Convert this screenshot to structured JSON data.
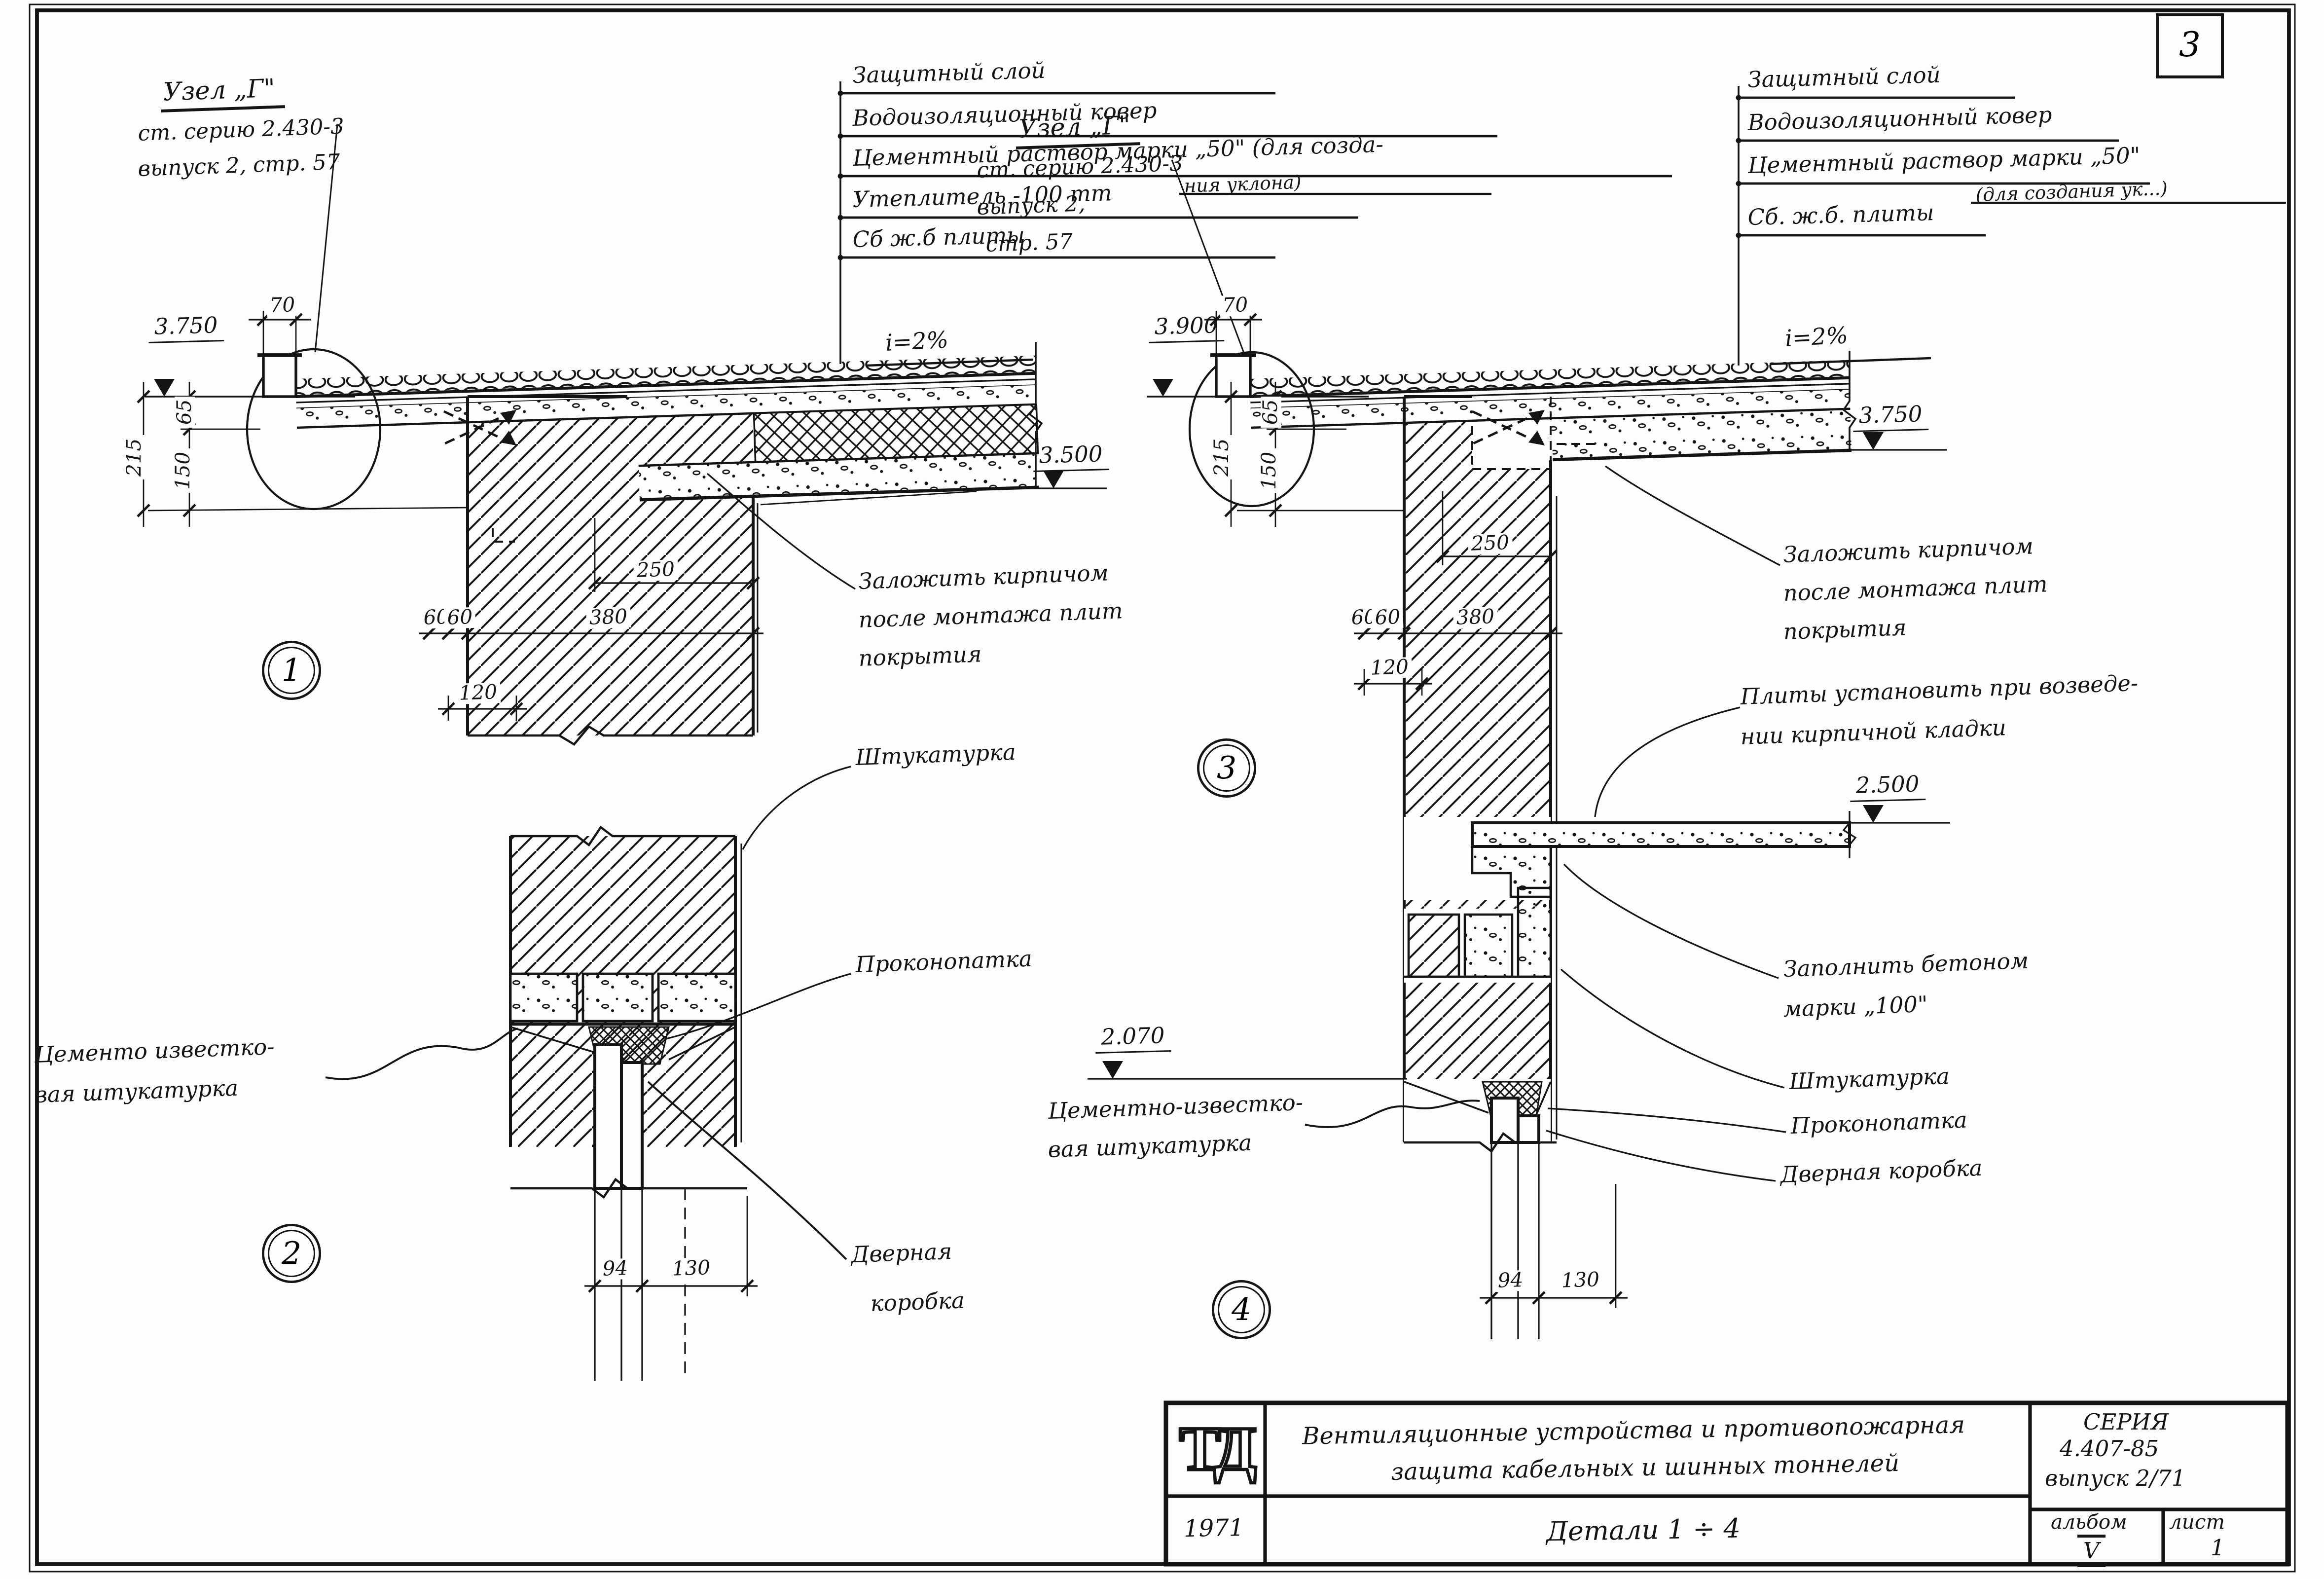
{
  "page": {
    "sheet_number": "3"
  },
  "callouts_left": {
    "l1": "Защитный слой",
    "l2": "Водоизоляционный ковер",
    "l3": "Цементный раствор марки „50\" (для созда-",
    "l3b": "ния уклона)",
    "l4": "Утеплитель -100 mm",
    "l5": "Сб ж.б плиты"
  },
  "callouts_right": {
    "l1": "Защитный слой",
    "l2": "Водоизоляционный ковер",
    "l3": "Цементный раствор марки „50\"",
    "l3b": "(для создания ук...)",
    "l4": "Сб. ж.б. плиты"
  },
  "node_ref_1": {
    "title": "Узел „Г\"",
    "ref1": "ст. серию 2.430-3",
    "ref2": "выпуск 2, стр. 57"
  },
  "node_ref_3": {
    "title": "Узел „Г\"",
    "ref1": "ст. серию 2.430-3",
    "ref2": "выпуск 2,",
    "ref3": "стр. 57"
  },
  "detail1": {
    "number": "1",
    "slope": "i=2%",
    "elev_top": "3.750",
    "elev_soffit": "3.500",
    "dim_70": "70",
    "dim_215": "215",
    "dim_150": "150",
    "dim_65": "65",
    "dim_250": "250",
    "dim_380": "380",
    "dim_60a": "60",
    "dim_60b": "60",
    "dim_120": "120",
    "note_brick_l1": "Заложить кирпичом",
    "note_brick_l2": "после монтажа плит",
    "note_brick_l3": "покрытия"
  },
  "detail2": {
    "number": "2",
    "label_plaster": "Штукатурка",
    "label_caulk": "Проконопатка",
    "label_cement_l1": "Цементо известко-",
    "label_cement_l2": "вая штукатурка",
    "label_door_l1": "Дверная",
    "label_door_l2": "коробка",
    "dim_94": "94",
    "dim_130": "130"
  },
  "detail3": {
    "number": "3",
    "slope": "i=2%",
    "elev_top": "3.900",
    "elev_right": "3.750",
    "dim_70": "70",
    "dim_215": "215",
    "dim_150": "150",
    "dim_65": "65",
    "dim_250": "250",
    "dim_380": "380",
    "dim_60a": "60",
    "dim_60b": "60",
    "dim_120": "120",
    "note_brick_l1": "Заложить кирпичом",
    "note_brick_l2": "после монтажа плит",
    "note_brick_l3": "покрытия",
    "note_plates_l1": "Плиты установить при возведе-",
    "note_plates_l2": "нии кирпичной кладки"
  },
  "detail4": {
    "number": "4",
    "elev_slab": "2.500",
    "elev_head": "2.070",
    "dim_94": "94",
    "dim_130": "130",
    "label_fill_l1": "Заполнить бетоном",
    "label_fill_l2": "марки „100\"",
    "label_plaster": "Штукатурка",
    "label_caulk": "Проконопатка",
    "label_door": "Дверная коробка",
    "label_cement_l1": "Цементно-известко-",
    "label_cement_l2": "вая штукатурка"
  },
  "title_block": {
    "logo": "ТД",
    "year": "1971",
    "title_l1": "Вентиляционные устройства и противопожарная",
    "title_l2": "защита кабельных и шинных тоннелей",
    "subtitle": "Детали 1 ÷ 4",
    "series_label": "СЕРИЯ",
    "series": "4.407-85",
    "issue": "выпуск 2/71",
    "album_label": "альбом",
    "album": "V",
    "sheet_label": "лист",
    "sheet": "1"
  }
}
